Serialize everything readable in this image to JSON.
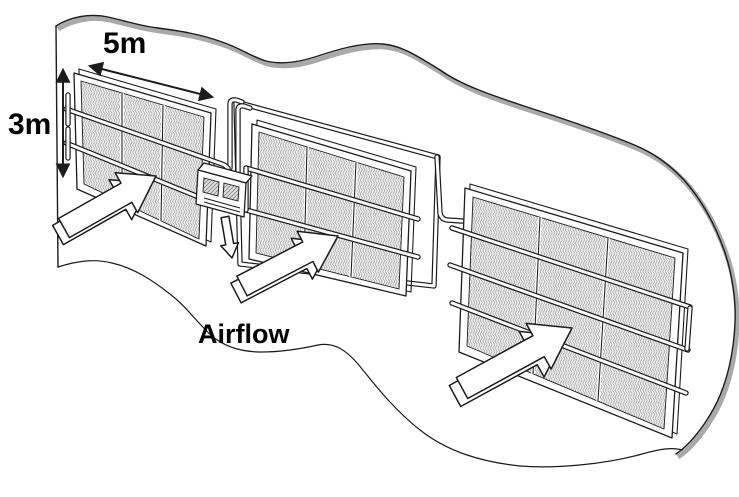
{
  "figure": {
    "kind": "technical-diagram",
    "panel_count": 3,
    "labels": {
      "panel_width": "5m",
      "panel_height": "3m",
      "airflow": "Airflow"
    },
    "colors": {
      "background": "#ffffff",
      "line": "#1c1c1c",
      "terrain_shadow": "#a9a9a9",
      "mesh_fill": "#ececec",
      "mesh_stroke": "#9b9b9b",
      "panel_fill": "#ffffff",
      "text": "#000000"
    },
    "icons": {
      "airflow_arrow": "hollow 3D arrow pointing up-right into panel",
      "down_arrow": "hollow arrow pointing down below device box",
      "width_dimension_arrow": "double-headed arrow along panel top edge",
      "height_dimension_arrow": "double-headed vertical arrow along panel left edge"
    }
  }
}
